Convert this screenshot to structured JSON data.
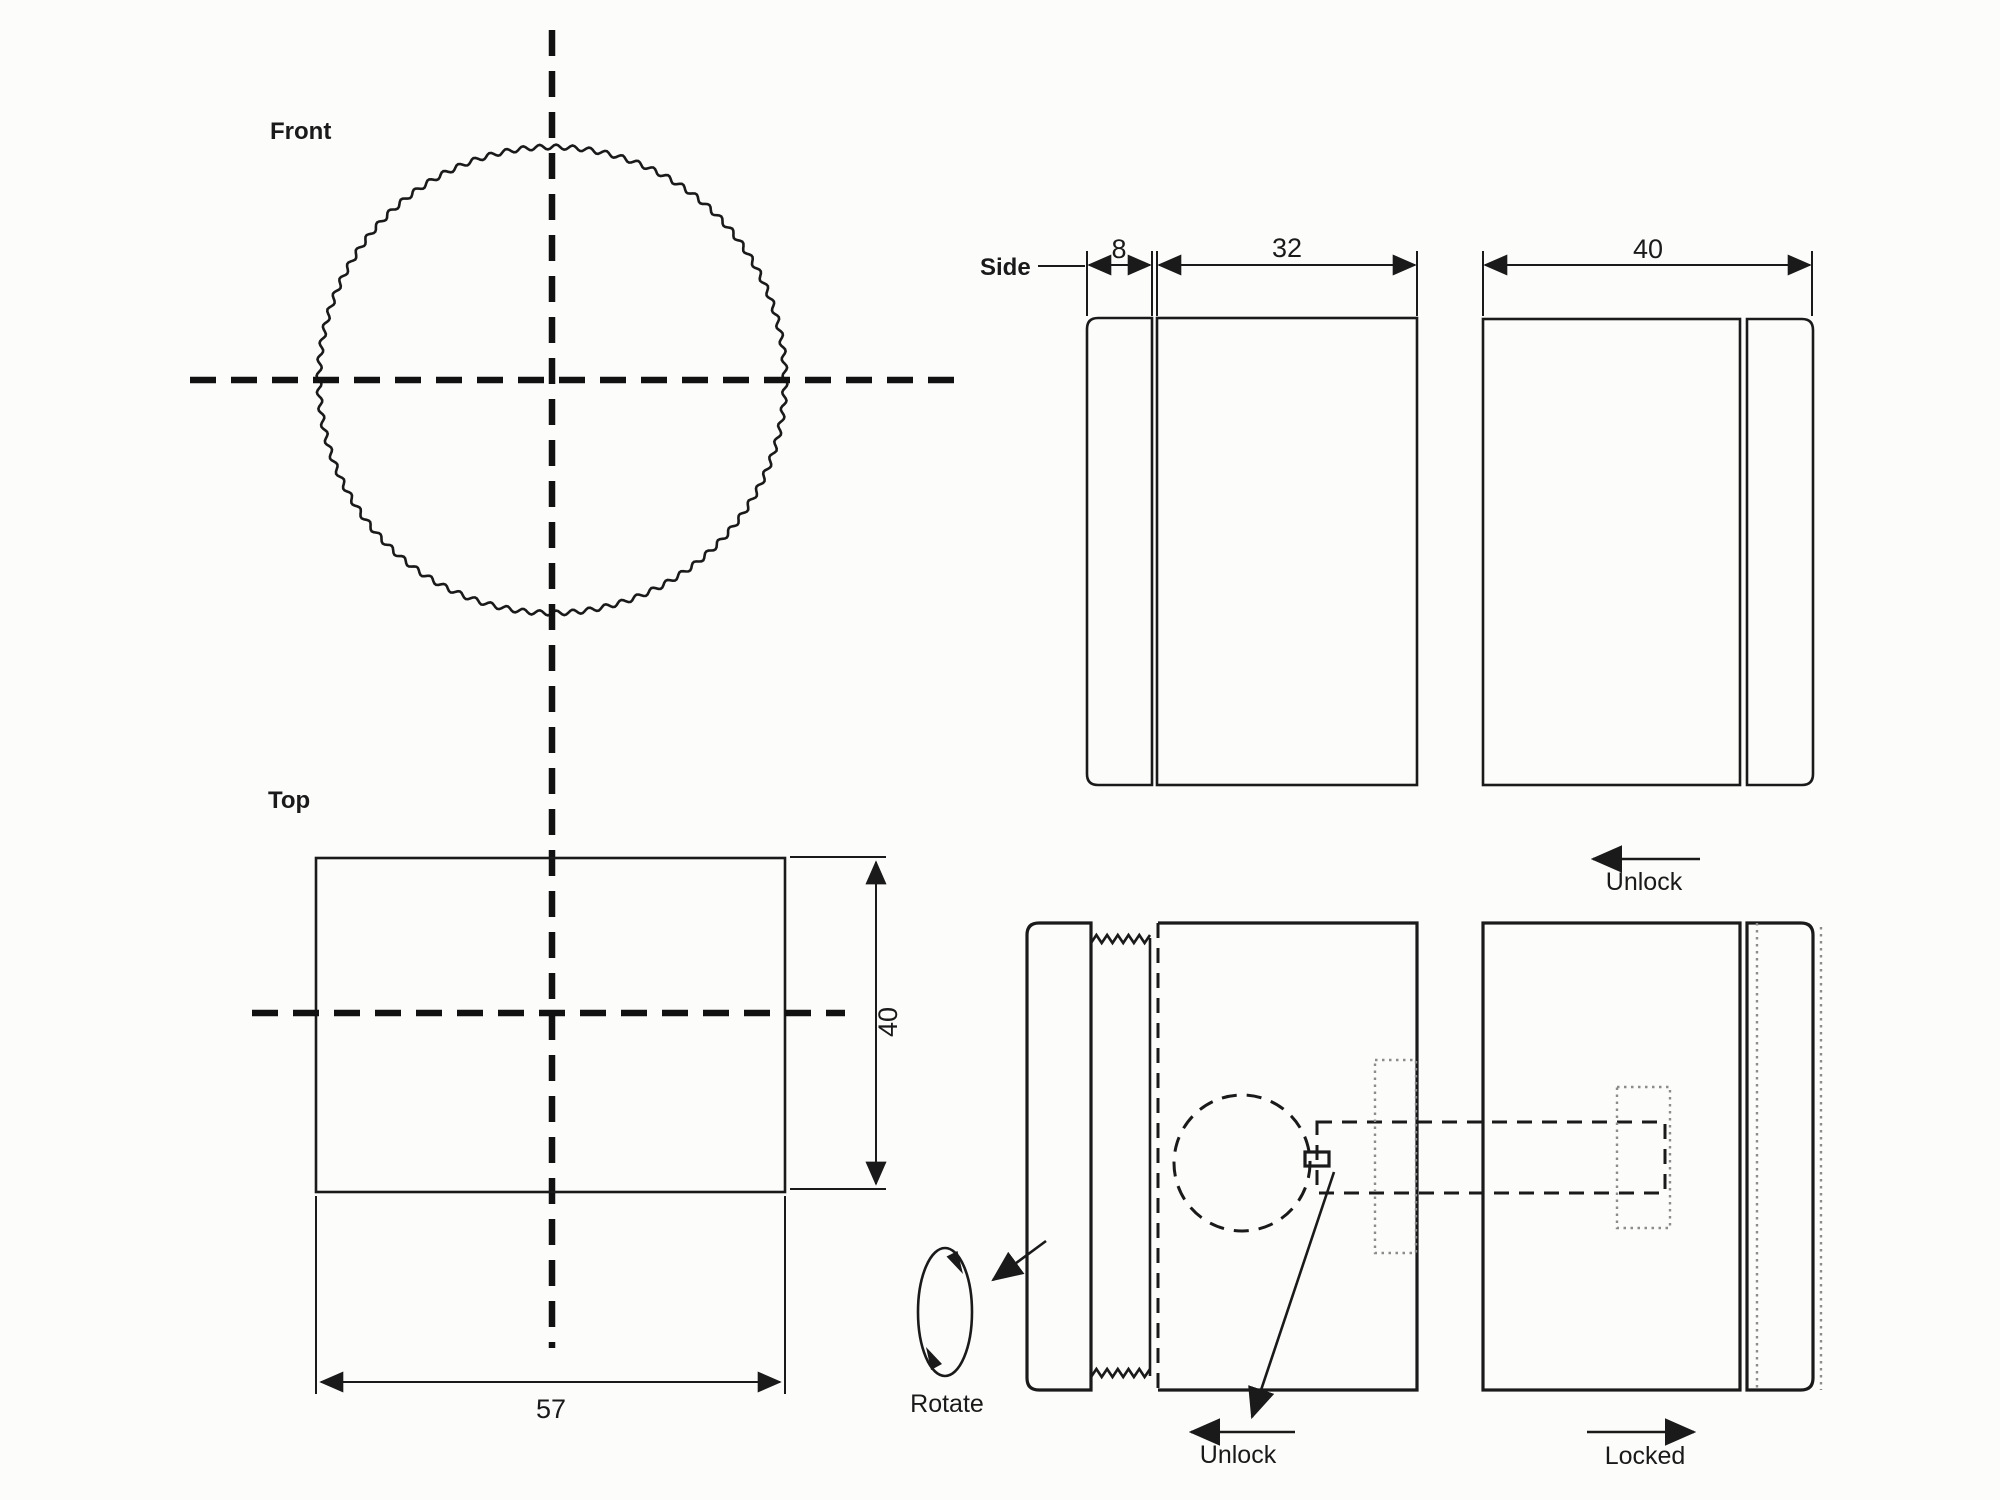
{
  "views": {
    "front": {
      "label": "Front"
    },
    "top": {
      "label": "Top"
    },
    "side": {
      "label": "Side"
    }
  },
  "dimensions": {
    "side_cap_width": "8",
    "side_body_width": "32",
    "side_total_width": "40",
    "top_depth": "40",
    "top_width": "57"
  },
  "annotations": {
    "unlock_direction": "Unlock",
    "rotate": "Rotate",
    "unlock_action": "Unlock",
    "locked": "Locked"
  },
  "colors": {
    "line": "#1a1a1a",
    "phantom": "#8c8c8c",
    "background": "#fcfcfb"
  }
}
